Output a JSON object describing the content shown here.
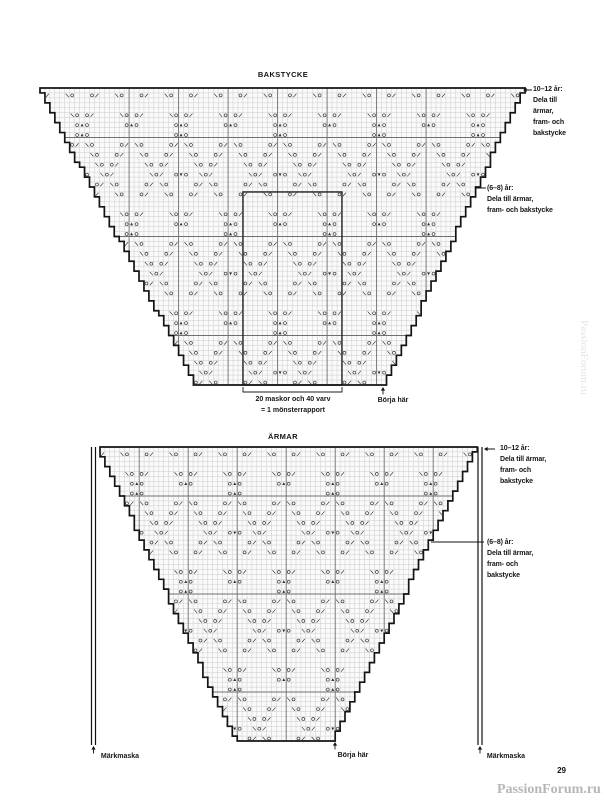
{
  "page": {
    "number": "29"
  },
  "watermarks": {
    "corner": "PassionForum.ru",
    "side": "PassionForum.ru"
  },
  "symbol_legend": {
    "O": "yarn-over",
    "/": "k2tog",
    "\\": "ssk",
    "▲": "double-decrease",
    "▼": "center-decrease"
  },
  "motif": {
    "cols": 20,
    "rows": 20,
    "entries": [
      [
        0,
        3,
        "\\"
      ],
      [
        0,
        4,
        "O"
      ],
      [
        0,
        6,
        "O"
      ],
      [
        0,
        7,
        "/"
      ],
      [
        0,
        13,
        "\\"
      ],
      [
        0,
        14,
        "O"
      ],
      [
        0,
        16,
        "O"
      ],
      [
        0,
        17,
        "/"
      ],
      [
        1,
        4,
        "O"
      ],
      [
        1,
        5,
        "▲"
      ],
      [
        1,
        6,
        "O"
      ],
      [
        1,
        14,
        "O"
      ],
      [
        1,
        15,
        "▲"
      ],
      [
        1,
        16,
        "O"
      ],
      [
        2,
        4,
        "O"
      ],
      [
        2,
        5,
        "▲"
      ],
      [
        2,
        6,
        "O"
      ],
      [
        3,
        3,
        "O"
      ],
      [
        3,
        4,
        "/"
      ],
      [
        3,
        6,
        "\\"
      ],
      [
        3,
        7,
        "O"
      ],
      [
        3,
        13,
        "O"
      ],
      [
        3,
        14,
        "/"
      ],
      [
        3,
        16,
        "\\"
      ],
      [
        3,
        17,
        "O"
      ],
      [
        4,
        2,
        "O"
      ],
      [
        4,
        3,
        "/"
      ],
      [
        4,
        7,
        "\\"
      ],
      [
        4,
        8,
        "O"
      ],
      [
        4,
        12,
        "O"
      ],
      [
        4,
        13,
        "/"
      ],
      [
        4,
        17,
        "\\"
      ],
      [
        4,
        18,
        "O"
      ],
      [
        5,
        1,
        "O"
      ],
      [
        5,
        2,
        "/"
      ],
      [
        5,
        8,
        "\\"
      ],
      [
        5,
        9,
        "O"
      ],
      [
        5,
        11,
        "O"
      ],
      [
        5,
        12,
        "/"
      ],
      [
        5,
        18,
        "\\"
      ],
      [
        5,
        19,
        "O"
      ],
      [
        6,
        0,
        "O"
      ],
      [
        6,
        1,
        "/"
      ],
      [
        6,
        4,
        "O"
      ],
      [
        6,
        5,
        "▼"
      ],
      [
        6,
        6,
        "O"
      ],
      [
        6,
        9,
        "\\"
      ],
      [
        6,
        10,
        "O"
      ],
      [
        6,
        11,
        "/"
      ],
      [
        6,
        19,
        "\\"
      ],
      [
        7,
        1,
        "\\"
      ],
      [
        7,
        2,
        "O"
      ],
      [
        7,
        8,
        "O"
      ],
      [
        7,
        9,
        "/"
      ],
      [
        7,
        11,
        "\\"
      ],
      [
        7,
        12,
        "O"
      ],
      [
        7,
        18,
        "O"
      ],
      [
        7,
        19,
        "/"
      ],
      [
        8,
        2,
        "\\"
      ],
      [
        8,
        3,
        "O"
      ],
      [
        8,
        7,
        "O"
      ],
      [
        8,
        8,
        "/"
      ],
      [
        8,
        12,
        "\\"
      ],
      [
        8,
        13,
        "O"
      ],
      [
        8,
        17,
        "O"
      ],
      [
        8,
        18,
        "/"
      ],
      [
        10,
        3,
        "\\"
      ],
      [
        10,
        4,
        "O"
      ],
      [
        10,
        6,
        "O"
      ],
      [
        10,
        7,
        "/"
      ],
      [
        10,
        13,
        "\\"
      ],
      [
        10,
        14,
        "O"
      ],
      [
        10,
        16,
        "O"
      ],
      [
        10,
        17,
        "/"
      ],
      [
        11,
        4,
        "O"
      ],
      [
        11,
        5,
        "▲"
      ],
      [
        11,
        6,
        "O"
      ],
      [
        11,
        14,
        "O"
      ],
      [
        11,
        15,
        "▲"
      ],
      [
        11,
        16,
        "O"
      ],
      [
        12,
        14,
        "O"
      ],
      [
        12,
        15,
        "▲"
      ],
      [
        12,
        16,
        "O"
      ],
      [
        13,
        3,
        "O"
      ],
      [
        13,
        4,
        "/"
      ],
      [
        13,
        6,
        "\\"
      ],
      [
        13,
        7,
        "O"
      ],
      [
        13,
        13,
        "O"
      ],
      [
        13,
        14,
        "/"
      ],
      [
        13,
        16,
        "\\"
      ],
      [
        13,
        17,
        "O"
      ],
      [
        14,
        2,
        "O"
      ],
      [
        14,
        3,
        "/"
      ],
      [
        14,
        7,
        "\\"
      ],
      [
        14,
        8,
        "O"
      ],
      [
        14,
        12,
        "O"
      ],
      [
        14,
        13,
        "/"
      ],
      [
        14,
        17,
        "\\"
      ],
      [
        14,
        18,
        "O"
      ],
      [
        15,
        1,
        "O"
      ],
      [
        15,
        2,
        "/"
      ],
      [
        15,
        8,
        "\\"
      ],
      [
        15,
        9,
        "O"
      ],
      [
        15,
        11,
        "O"
      ],
      [
        15,
        12,
        "/"
      ],
      [
        15,
        18,
        "\\"
      ],
      [
        15,
        19,
        "O"
      ],
      [
        16,
        0,
        "O"
      ],
      [
        16,
        1,
        "/"
      ],
      [
        16,
        9,
        "\\"
      ],
      [
        16,
        10,
        "O"
      ],
      [
        16,
        11,
        "/"
      ],
      [
        16,
        14,
        "O"
      ],
      [
        16,
        15,
        "▼"
      ],
      [
        16,
        16,
        "O"
      ],
      [
        16,
        19,
        "\\"
      ],
      [
        17,
        1,
        "\\"
      ],
      [
        17,
        2,
        "O"
      ],
      [
        17,
        8,
        "O"
      ],
      [
        17,
        9,
        "/"
      ],
      [
        17,
        11,
        "\\"
      ],
      [
        17,
        12,
        "O"
      ],
      [
        17,
        18,
        "O"
      ],
      [
        17,
        19,
        "/"
      ],
      [
        18,
        2,
        "\\"
      ],
      [
        18,
        3,
        "O"
      ],
      [
        18,
        7,
        "O"
      ],
      [
        18,
        8,
        "/"
      ],
      [
        18,
        12,
        "\\"
      ],
      [
        18,
        13,
        "O"
      ],
      [
        18,
        17,
        "O"
      ],
      [
        18,
        18,
        "/"
      ]
    ]
  },
  "charts": [
    {
      "name": "bakstycke",
      "title": "BAKSTYCKE",
      "x": 40,
      "y": 88,
      "cell": 4.95,
      "cols": 98,
      "rows": 60,
      "left_top_col": 0,
      "left_bottom_col": 32,
      "right_top_col": 98,
      "right_bottom_col": 70,
      "repeat_line_cols": [
        18,
        28,
        38,
        48,
        58,
        68,
        78
      ],
      "band_line_rows": [
        10,
        30,
        50
      ],
      "col_phase": 3,
      "row_phase": 2,
      "repeat_box": {
        "col1": 41,
        "col2": 61,
        "row1": 21
      },
      "bracket": {
        "x1": 243,
        "x2": 342,
        "y": 392,
        "lines": [
          "20 maskor och 40 varv",
          "= 1 mönsterrapport"
        ]
      },
      "start_label": "Börja här",
      "start_arrow": {
        "x": 383,
        "y": 387
      },
      "annotations": [
        {
          "id": "size-10-12",
          "lines": [
            "10–12 år:",
            "Dela till",
            "ärmar,",
            "fram- och",
            "bakstycke"
          ],
          "arrow": {
            "tip_x": 523,
            "tip_y": 90,
            "tail_x": 532
          }
        },
        {
          "id": "size-6-8",
          "lines": [
            "(6–8) år:",
            "Dela till ärmar,",
            "fram- och bakstycke"
          ],
          "pointer": {
            "x1": 475,
            "x2": 486,
            "y": 188
          }
        }
      ]
    },
    {
      "name": "armar",
      "title": "ÄRMAR",
      "x": 100,
      "y": 447,
      "cell": 4.9,
      "cols": 77,
      "rows": 60,
      "left_top_col": 0,
      "left_bottom_col": 28,
      "right_top_col": 77,
      "right_bottom_col": 48,
      "repeat_line_cols": [
        8,
        18,
        28,
        38,
        48,
        58,
        68
      ],
      "band_line_rows": [
        10,
        30,
        50
      ],
      "col_phase": 2,
      "row_phase": 2,
      "markers": {
        "label": "Märkmaska",
        "left_x": [
          91.5,
          95.5
        ],
        "right_x": [
          478,
          482
        ],
        "top": 447,
        "bottom": 745,
        "arrow_y": 746
      },
      "start_label": "Börja här",
      "start_arrow": {
        "x": 335,
        "y": 742
      },
      "annotations": [
        {
          "id": "size-10-12",
          "lines": [
            "10–12 år:",
            "Dela till ärmar,",
            "fram- och",
            "bakstycke"
          ],
          "arrow": {
            "tip_x": 484,
            "tip_y": 449,
            "tail_x": 495
          }
        },
        {
          "id": "size-6-8",
          "lines": [
            "(6–8) år:",
            "Dela till ärmar,",
            "fram- och",
            "bakstycke"
          ],
          "pointer": {
            "x1": 431,
            "x2": 484,
            "y": 542
          }
        }
      ]
    }
  ]
}
